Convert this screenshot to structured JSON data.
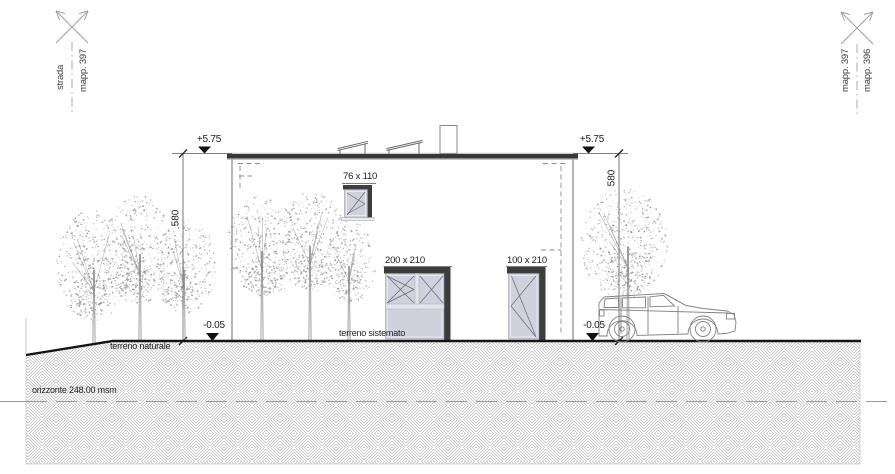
{
  "boundary_markers": {
    "top_left": {
      "labels": [
        "strada",
        "mapp. 397"
      ]
    },
    "top_right": {
      "labels": [
        "mapp. 397",
        "mapp. 396"
      ]
    }
  },
  "levels": {
    "roof_left": "+5.75",
    "roof_right": "+5.75",
    "ground_left": "-0.05",
    "ground_right": "-0.05",
    "height_left": "580",
    "height_right": "580"
  },
  "openings": {
    "small_window_label": "76 x 110",
    "large_window_label": "200 x 210",
    "door_label": "100 x 210"
  },
  "terrain": {
    "natural_label": "terreno naturale",
    "arranged_label": "terreno sistemato",
    "horizon_label": "orizzonte 248.00 msm"
  },
  "colors": {
    "glass": "#d0d1dd",
    "glass_inner": "#e9e9f1",
    "frame": "#3d3d3d",
    "roof": "#383838",
    "ground_line": "#141414",
    "hatch_line": "#b6b6b6",
    "sketch": "#8a8a8a",
    "thin_line": "#7a7a7a",
    "marker": "#9f9f9f"
  }
}
